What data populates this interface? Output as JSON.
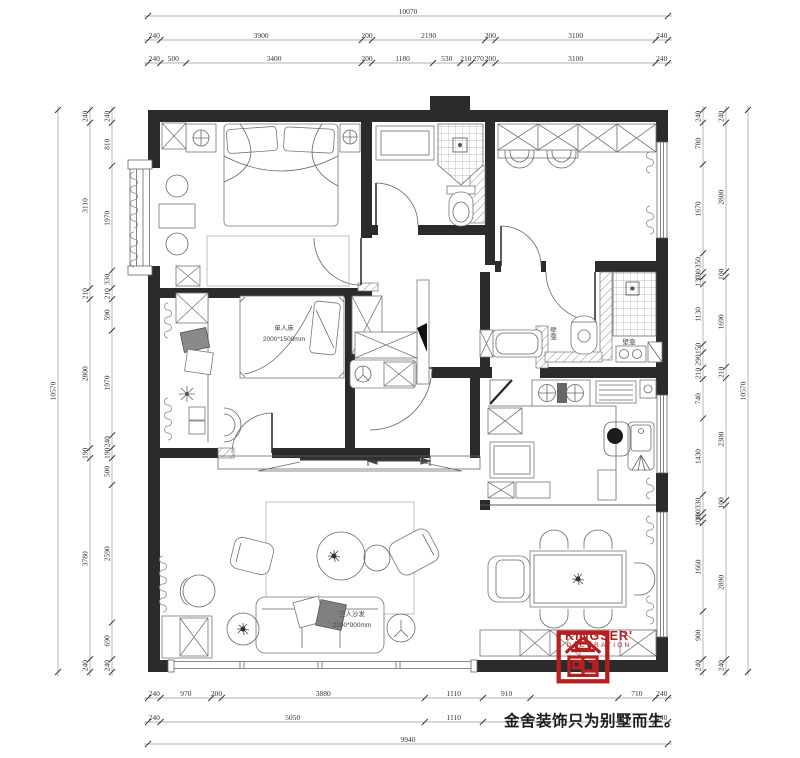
{
  "brand": {
    "name": "KINGSER'",
    "sub": "DECORATION",
    "slogan": "金舍装饰只为别墅而生。",
    "red": "#b51f1f"
  },
  "plan_labels": {
    "single_bed_title": "单人床",
    "single_bed_size": "2000*1500mm",
    "sofa_title": "三人沙发",
    "sofa_size": "2200*900mm",
    "niche_left": "壁龛",
    "niche_right": "壁龛"
  },
  "dimensions": {
    "top_total": [
      10070
    ],
    "top_row1": [
      240,
      3900,
      200,
      2190,
      200,
      3100,
      240
    ],
    "top_row2": [
      240,
      500,
      3400,
      200,
      1180,
      530,
      210,
      270,
      200,
      3100,
      240
    ],
    "bottom_row1": [
      240,
      970,
      200,
      3880,
      1110,
      910,
      {
        "v": 1680,
        "label": ""
      },
      710,
      240
    ],
    "bottom_row2": [
      240,
      5050,
      1110,
      {
        "v": 3300,
        "label": ""
      },
      240
    ],
    "bottom_total": [
      9940
    ],
    "left_outer": [
      10570
    ],
    "left_mid": [
      240,
      3110,
      210,
      2800,
      190,
      3780,
      240
    ],
    "left_inner": [
      240,
      810,
      1970,
      330,
      210,
      590,
      1970,
      240,
      190,
      500,
      2590,
      690,
      240
    ],
    "right_inner": [
      240,
      780,
      1670,
      350,
      100,
      130,
      1130,
      150,
      290,
      210,
      740,
      1430,
      330,
      100,
      100,
      1660,
      900,
      240
    ],
    "right_mid": [
      240,
      2800,
      100,
      1690,
      210,
      2300,
      100,
      2890,
      240
    ],
    "right_outer": [
      10570
    ]
  }
}
